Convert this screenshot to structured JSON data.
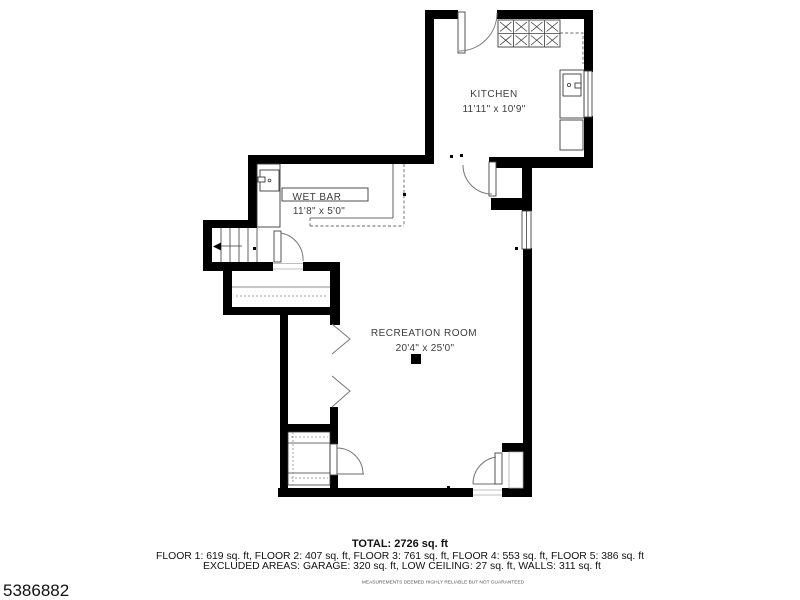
{
  "rooms": {
    "kitchen": {
      "name": "KITCHEN",
      "dims": "11'11\" x 10'9\""
    },
    "wet_bar": {
      "name": "WET BAR",
      "dims": "11'8\" x 5'0\""
    },
    "recreation": {
      "name": "RECREATION ROOM",
      "dims": "20'4\" x 25'0\""
    }
  },
  "summary": {
    "total": "TOTAL: 2726 sq. ft",
    "floors": "FLOOR 1: 619 sq. ft, FLOOR 2: 407 sq. ft, FLOOR 3: 761 sq. ft, FLOOR 4: 553 sq. ft, FLOOR 5: 386 sq. ft",
    "excluded": "EXCLUDED AREAS: GARAGE: 320 sq. ft, LOW CEILING: 27 sq. ft, WALLS: 311 sq. ft",
    "disclaimer": "MEASUREMENTS DEEMED HIGHLY RELIABLE BUT NOT GUARANTEED"
  },
  "areas": {
    "total_sqft": 2726,
    "floors": [
      {
        "label": "FLOOR 1",
        "sqft": 619
      },
      {
        "label": "FLOOR 2",
        "sqft": 407
      },
      {
        "label": "FLOOR 3",
        "sqft": 761
      },
      {
        "label": "FLOOR 4",
        "sqft": 553
      },
      {
        "label": "FLOOR 5",
        "sqft": 386
      }
    ],
    "excluded": [
      {
        "label": "GARAGE",
        "sqft": 320
      },
      {
        "label": "LOW CEILING",
        "sqft": 27
      },
      {
        "label": "WALLS",
        "sqft": 311
      }
    ]
  },
  "mls_number": "5386882",
  "colors": {
    "wall": "#000000",
    "text": "#3d3d3d",
    "background": "#ffffff"
  }
}
